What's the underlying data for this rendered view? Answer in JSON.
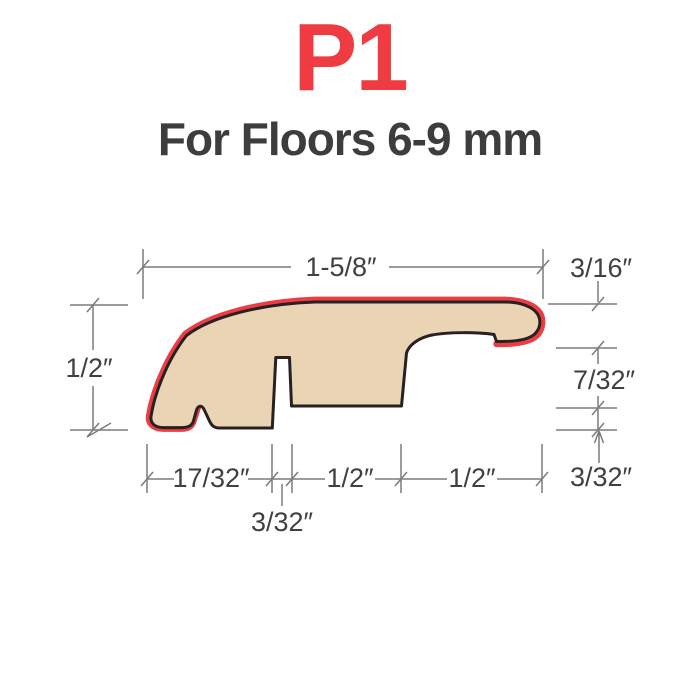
{
  "title": "P1",
  "subtitle": "For Floors 6-9 mm",
  "colors": {
    "accent_red": "#ee3c42",
    "wood_fill": "#ebd4b4",
    "outline_black": "#262122",
    "dimension_line_gray": "#7a7c7f",
    "dimension_text": "#3e4043"
  },
  "dimensions": {
    "top_width": "1-5/8″",
    "top_right_thickness": "3/16″",
    "left_height": "1/2″",
    "right_gap_height": "7/32″",
    "right_rabbet_depth": "3/32″",
    "bottom_left_width": "17/32″",
    "bottom_slot_width": "3/32″",
    "bottom_mid_width": "1/2″",
    "bottom_right_width": "1/2″"
  }
}
